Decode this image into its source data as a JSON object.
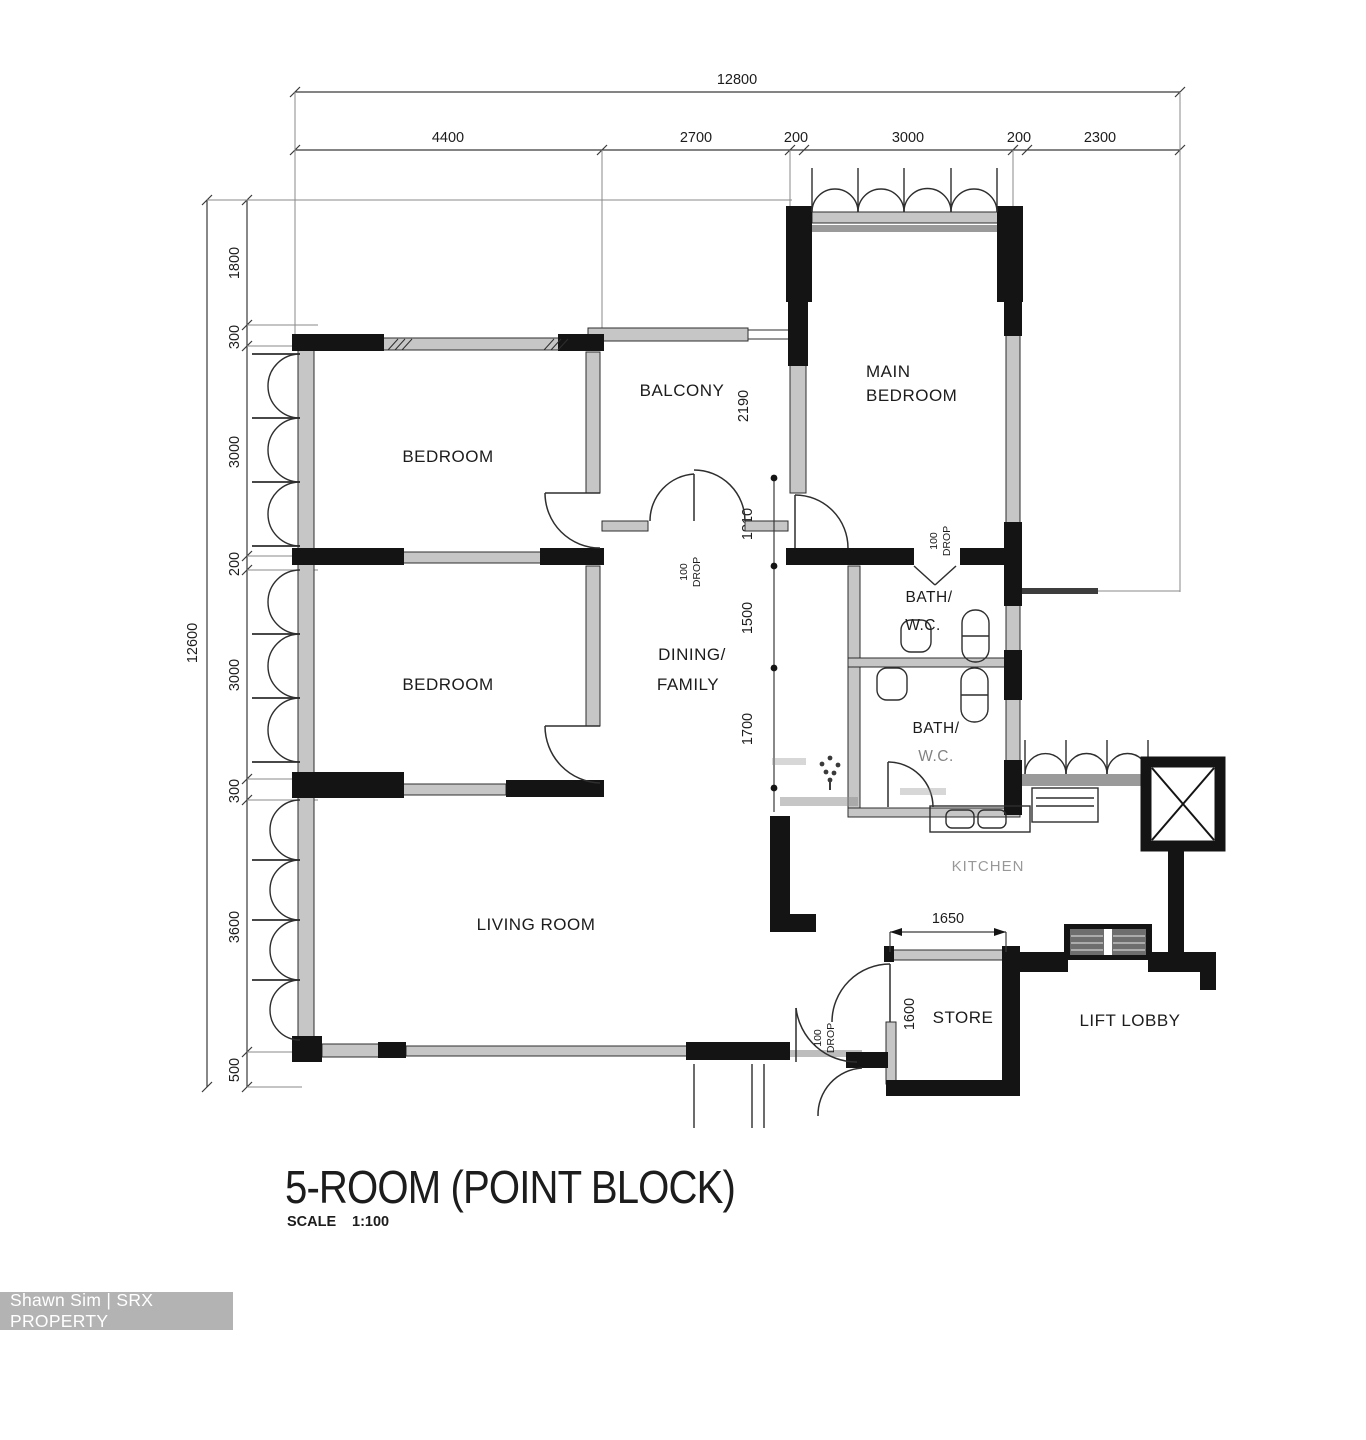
{
  "title": {
    "name": "5-ROOM (POINT BLOCK)",
    "scale_word": "SCALE",
    "scale_value": "1:100"
  },
  "watermark": {
    "text": "Shawn Sim | SRX PROPERTY"
  },
  "rooms": {
    "bedroom_top": "BEDROOM",
    "bedroom_bottom": "BEDROOM",
    "main_bedroom_line1": "MAIN",
    "main_bedroom_line2": "BEDROOM",
    "balcony": "BALCONY",
    "dining_line1": "DINING/",
    "dining_line2": "FAMILY",
    "living": "LIVING ROOM",
    "bath_upper_line1": "BATH/",
    "bath_upper_line2": "W.C.",
    "bath_lower_line1": "BATH/",
    "bath_lower_line2": "W.C.",
    "kitchen": "KITCHEN",
    "store": "STORE",
    "lift_lobby": "LIFT LOBBY"
  },
  "dimensions": {
    "overall_width": "12800",
    "overall_height": "12600",
    "top_segments": [
      "4400",
      "2700",
      "200",
      "3000",
      "200",
      "2300"
    ],
    "left_segments": [
      "1800",
      "300",
      "3000",
      "200",
      "3000",
      "300",
      "3600",
      "500"
    ],
    "interior_heights": [
      "1310",
      "1500",
      "1700"
    ],
    "balcony_depth": "2190",
    "kitchen_width": "1650",
    "store_depth": "1600"
  },
  "annotations": {
    "drop_value": "100",
    "drop_word": "DROP"
  }
}
